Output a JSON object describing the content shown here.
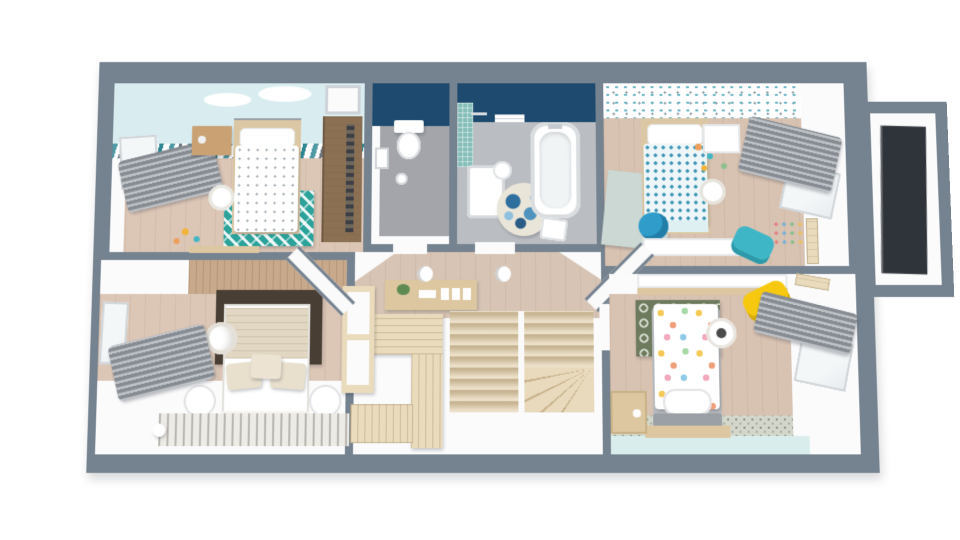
{
  "app": {
    "type": "3d-floor-plan-render",
    "view": "top-down-perspective",
    "storey": "upper-floor",
    "background": "#ffffff"
  },
  "palette": {
    "wall": "#75828F",
    "roomWhite": "#FBFBFC",
    "woodFloor": "#DCC6B6",
    "woodFloor2": "#D8C2B1",
    "hallFloor": "#D7C4B4",
    "navy": "#1D4A6E",
    "cyanWall": "#D9EDF0",
    "mint": "#D9EDEC",
    "wcFloor": "#A3A5AB",
    "bathFloor": "#BABDC2",
    "mosaic": "#85BDB8",
    "tealRug": "#2BA29A",
    "paleRug": "#CCD8D3",
    "darkRug": "#493E33",
    "greenRug": "#6D7A5E",
    "stripeRug": "#EDEBE6",
    "tileStrip": "#D3D6CA",
    "stairsWood": "#E5D5B6",
    "closetWood": "#EADBBC",
    "furnitureWood": "#DCC7A0",
    "nightstandWood": "#C9A173",
    "wardrobeWood": "#8B7054",
    "wallWood": "#C8A98C",
    "bedFrameWood": "#DCC7A4",
    "curtain": "#9BA1A8",
    "yellowChair": "#F6C810",
    "tealChair": "#3FB6C6",
    "owlBlue": "#2F9CC9",
    "darkPanel": "#2F343A",
    "headboardGray": "#9AA0A5",
    "beddingBeige": "#E2D7C2",
    "duvetFold": "#DFF0F3",
    "white": "#FFFFFF"
  },
  "rooms": [
    {
      "id": "bedroom-top-left",
      "name": "Kids bedroom 1",
      "accent_wall": "cyan cloud mural",
      "floor": "wood",
      "furniture": [
        "single-bed",
        "gray-headboard",
        "pillow",
        "wood-nightstand",
        "sphere-floor-lamp",
        "teal-chevron-rug",
        "open-wardrobe",
        "closet-niche",
        "window",
        "gray-curtains",
        "low-shelf",
        "toys"
      ]
    },
    {
      "id": "wc",
      "name": "Separate toilet",
      "accent_wall": "navy",
      "floor": "gray",
      "furniture": [
        "wall-hung-toilet",
        "picture-frame",
        "waste-bin"
      ]
    },
    {
      "id": "bathroom",
      "name": "Bathroom",
      "accent_wall": "navy",
      "floor": "gray",
      "furniture": [
        "bathtub",
        "bath-tap",
        "shower-tray",
        "mosaic-shower-wall",
        "shower-head",
        "pedestal-sink",
        "floral-round-rug",
        "towel-rail",
        "laundry-basket"
      ]
    },
    {
      "id": "bedroom-top-right",
      "name": "Kids bedroom 2",
      "accent_wall": "teal pattern wallpaper",
      "floor": "wood",
      "furniture": [
        "single-bed",
        "teal-dot-duvet",
        "white-nightstand",
        "sphere-lamp",
        "pale-rug",
        "owl-plush",
        "toys",
        "window",
        "gray-curtains",
        "wall-stickers",
        "growth-chart",
        "desk",
        "teal-chair"
      ]
    },
    {
      "id": "bedroom-bottom-left",
      "name": "Master bedroom",
      "accent_wall": "wood plank headboard wall",
      "floor": "wood",
      "furniture": [
        "double-bed",
        "beige-bedding",
        "pillows",
        "dark-brown-rug",
        "round-nightstand-left",
        "round-nightstand-right",
        "pendant-lamp",
        "window",
        "gray-curtains",
        "striped-rug",
        "white-ball"
      ]
    },
    {
      "id": "hallway",
      "name": "Landing",
      "accent_wall": "none",
      "floor": "wood",
      "furniture": [
        "console-table",
        "plant",
        "ceiling-light-1",
        "ceiling-light-2",
        "winder-staircase",
        "built-in-closet",
        "slatted-platform",
        "tall-wardrobe"
      ]
    },
    {
      "id": "bedroom-bottom-right",
      "name": "Kids bedroom 3",
      "accent_wall": "mint band + patterned tiles",
      "floor": "wood",
      "furniture": [
        "single-bed",
        "confetti-dot-duvet",
        "gray-footboard",
        "wood-base-plate",
        "green-pattern-rug",
        "pendant-sphere-lamp",
        "toy-chest",
        "desk",
        "yellow-chair",
        "growth-chart",
        "window",
        "gray-curtains"
      ]
    },
    {
      "id": "bay-window",
      "name": "Bay window",
      "accent_wall": "none",
      "floor": "none",
      "furniture": [
        "dark-glazing-panel"
      ]
    }
  ]
}
